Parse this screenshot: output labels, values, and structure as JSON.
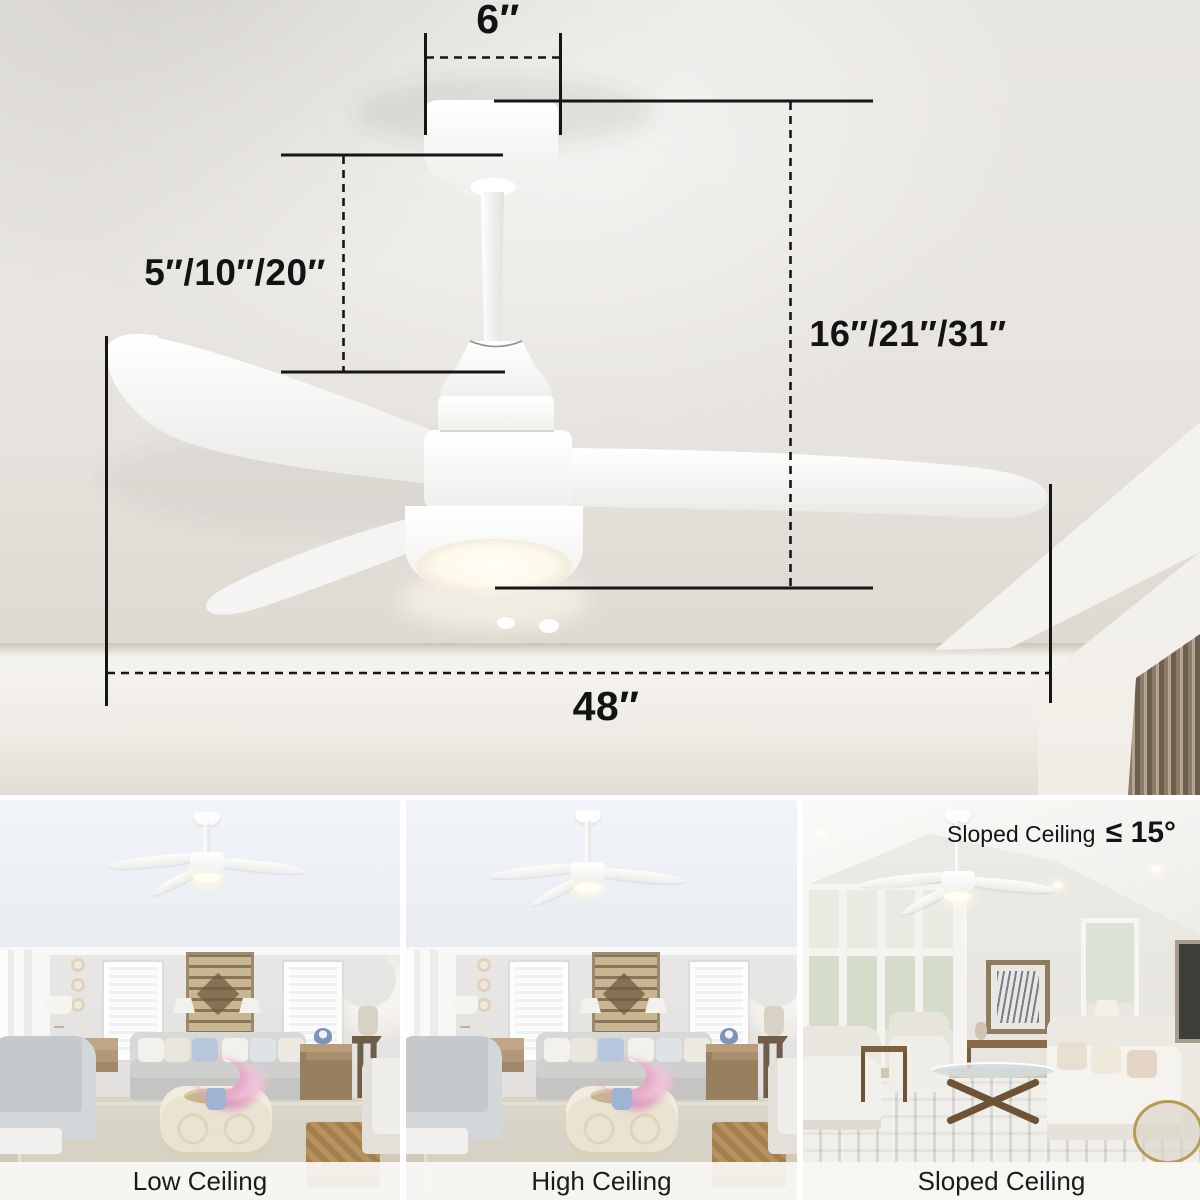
{
  "product_diagram": {
    "canopy_width_label": "6″",
    "downrod_length_label": "5″/10″/20″",
    "hanging_height_label": "16″/21″/31″",
    "blade_span_label": "48″"
  },
  "gallery": {
    "scenes": [
      {
        "caption": "Low Ceiling"
      },
      {
        "caption": "High Ceiling"
      },
      {
        "caption": "Sloped Ceiling"
      }
    ],
    "slope_note": {
      "text": "Sloped Ceiling",
      "limit": "≤ 15°"
    }
  },
  "colors": {
    "annotation": "#131313",
    "ceiling_background": "#e7e4df",
    "fan_body": "#ffffff",
    "light_glow": "#fffdf2",
    "slat_wood": "#8b7b67"
  }
}
